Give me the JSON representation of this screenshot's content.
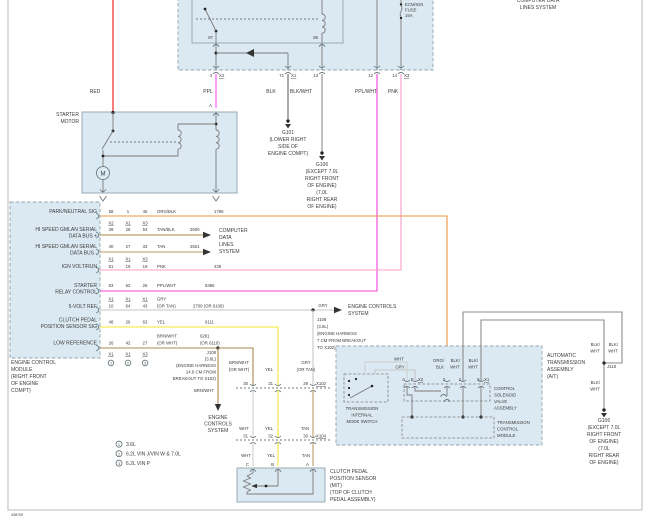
{
  "doc": {
    "number": "438709"
  },
  "colors": {
    "red": "#f01010",
    "ppl": "#fa50fa",
    "ppl_wht": "#fa3cd8",
    "pnk": "#ff9ec8",
    "org_blk": "#eb9840",
    "tan_blk": "#a8873c",
    "tan": "#b79d62",
    "yel": "#f4e82e",
    "gry": "#c6c6c6",
    "wht": "#cfcfcf",
    "brn_wht": "#aa8850",
    "blk": "#646464",
    "blk_wht": "#8c8c8c",
    "box_fill": "#dbeaf2",
    "border": "#8fa3ad",
    "text": "#3b3b3b"
  },
  "top_right": {
    "lines": [
      "COMPUTER DATA",
      "LINES SYSTEM"
    ]
  },
  "fuse_block": {
    "relay_pins": {
      "left": "87",
      "right": "86"
    },
    "fuse": {
      "line1": "ECM/IGN",
      "line2": "FUSE",
      "line3": "15A"
    },
    "pins": [
      {
        "num": "4",
        "conn": "X2"
      },
      {
        "num": "71",
        "conn": "X1"
      },
      {
        "num": "13",
        "conn": ""
      },
      {
        "num": "12",
        "conn": ""
      },
      {
        "num": "14",
        "conn": "X3"
      }
    ]
  },
  "wire_labels": {
    "red": "RED",
    "ppl": "PPL",
    "ppl_terminal": "A",
    "blk": "BLK",
    "blkwht": "BLK/WHT",
    "pplwht": "PPL/WHT",
    "pnk": "PNK",
    "brnwht_vert": "BRN/WHT",
    "gry_tap": "GRY",
    "above_x102": {
      "w1a": "BRN/WHT",
      "w1b": "(OR WHT)",
      "w2": "YEL",
      "w3a": "GRY",
      "w3b": "(OR TAN)"
    },
    "x102_to_x104": [
      "WHT",
      "YEL",
      "TAN"
    ],
    "x104_to_sensor": [
      "WHT",
      "YEL",
      "TAN"
    ],
    "trans": {
      "w1a": "ORG/",
      "w1b": "BLK",
      "w2a": "BLK/",
      "w2b": "WHT",
      "w3a": "BLK/",
      "w3b": "WHT"
    },
    "trans_internal": {
      "wht": "WHT",
      "gry": "GRY"
    },
    "right1a": "BLK/",
    "right1b": "WHT",
    "right2a": "BLK/",
    "right2b": "WHT",
    "right3a": "BLK/",
    "right3b": "WHT"
  },
  "grounds": {
    "g101": {
      "name": "G101",
      "lines": [
        "(LOWER RIGHT",
        "SIDE OF",
        "ENGINE COMPT)"
      ]
    },
    "g106_top": {
      "name": "G106",
      "lines": [
        "(EXCEPT 7.0L",
        "RIGHT FRONT",
        "OF ENGINE)",
        "(7.0L",
        "RIGHT REAR",
        "OF ENGINE)"
      ]
    },
    "g106_right": {
      "name": "G106",
      "lines": [
        "(EXCEPT 7.0L",
        "RIGHT FRONT",
        "OF ENGINE)",
        "(7.0L",
        "RIGHT REAR",
        "OF ENGINE)"
      ]
    },
    "j118": "J118"
  },
  "starter": {
    "label": [
      "STARTER",
      "MOTOR"
    ],
    "motor": "M"
  },
  "ecm": {
    "rows": [
      {
        "label": [
          "PARK/NEUTRAL SIG"
        ],
        "pins": [
          "58",
          "1",
          "46"
        ],
        "color": [
          "ORG/BLK"
        ],
        "circuit": [
          "1786"
        ]
      },
      {
        "label": [
          "HI SPEED GMLAN SERIAL",
          "DATA BUS +"
        ],
        "pins": [
          "39",
          "28",
          "53"
        ],
        "color": [
          "TAN/BLK"
        ],
        "circuit": [
          "2500"
        ]
      },
      {
        "label": [
          "HI SPEED GMLAN SERIAL",
          "DATA BUS -"
        ],
        "pins": [
          "40",
          "27",
          "33"
        ],
        "color": [
          "TAN"
        ],
        "circuit": [
          "2501"
        ]
      },
      {
        "label": [
          "IGN VOLT/RUN"
        ],
        "pins": [
          "51",
          "19",
          "19"
        ],
        "color": [
          "PNK"
        ],
        "circuit": [
          "439"
        ]
      },
      {
        "label": [
          "STARTER",
          "RELAY CONTROL"
        ],
        "pins": [
          "63",
          "52",
          "26"
        ],
        "color": [
          "PPL/WHT"
        ],
        "circuit": [
          "6386"
        ]
      },
      {
        "label": [
          "5-VOLT REF"
        ],
        "pins": [
          "10",
          "64",
          "43"
        ],
        "color": [
          "GRY",
          "(OR TAN)"
        ],
        "circuit": [
          "2709  (OR 6109)"
        ]
      },
      {
        "label": [
          "CLUTCH PEDAL",
          "POSITION SENSOR SIG"
        ],
        "pins": [
          "48",
          "26",
          "63"
        ],
        "color": [
          "YEL"
        ],
        "circuit": [
          "6111"
        ]
      },
      {
        "label": [
          "LOW REFERENCE"
        ],
        "pins": [
          "26",
          "42",
          "27"
        ],
        "color": [
          "BRN/WHT",
          "(OR WHT)"
        ],
        "circuit": [
          "6281",
          "(OR 6110)"
        ]
      }
    ],
    "connectors": [
      [
        "X2",
        "X1",
        "X3"
      ],
      [
        "X1",
        "X1",
        "X3"
      ],
      [
        "X1",
        "X1",
        "X1"
      ],
      [
        "X1",
        "X1",
        "X3"
      ]
    ],
    "variants": [
      "1",
      "2",
      "3"
    ],
    "label": [
      "ENGINE CONTROL",
      "MODULE",
      "(RIGHT FRONT",
      "OF ENGINE",
      "COMPT)"
    ]
  },
  "destinations": {
    "computer_data": [
      "COMPUTER",
      "DATA",
      "LINES",
      "SYSTEM"
    ],
    "engine_controls_right": [
      "ENGINE CONTROLS",
      "SYSTEM"
    ],
    "engine_controls_down": [
      "ENGINE",
      "CONTROLS",
      "SYSTEM"
    ]
  },
  "splices": {
    "j109": [
      "J109",
      "(3.6L)",
      "(ENGINE HARNESS",
      "7 CM FROM BREAKOUT",
      "TO X102)"
    ],
    "j108": [
      "J108",
      "(3.6L)",
      "(ENGINE HARNESS",
      "14.6 CM FROM",
      "BREAKOUT TO X102)"
    ]
  },
  "inline_connectors": {
    "x102": {
      "name": "X102",
      "pins": [
        "30",
        "31",
        "29"
      ]
    },
    "x104": {
      "name": "X104",
      "pins": [
        "31",
        "32",
        "30"
      ]
    }
  },
  "sensor": {
    "pins": [
      "C",
      "B",
      "A"
    ],
    "label": [
      "CLUTCH PEDAL",
      "POSITION SENSOR",
      "(M/T)",
      "(TOP OF CLUTCH",
      "PEDAL ASSEMBLY)"
    ]
  },
  "legend": [
    {
      "mark": "1",
      "text": "3.6L"
    },
    {
      "mark": "2",
      "text": "6.2L VIN J/VIN W & 7.0L"
    },
    {
      "mark": "3",
      "text": "6.2L VIN P"
    }
  ],
  "transmission": {
    "assembly": [
      "AUTOMATIC",
      "TRANSMISSION",
      "ASSEMBLY",
      "(A/T)"
    ],
    "mode_switch": [
      "TRANSMISSION",
      "INTERNAL",
      "MODE SWITCH"
    ],
    "csva": [
      "CONTROL",
      "SOLENOID",
      "VALVE",
      "ASSEMBLY"
    ],
    "tcm": [
      "TRANSMISSION",
      "CONTROL",
      "MODULE"
    ],
    "pins": [
      "A",
      "F",
      "X2",
      "3",
      "2",
      "5",
      "X1"
    ]
  }
}
